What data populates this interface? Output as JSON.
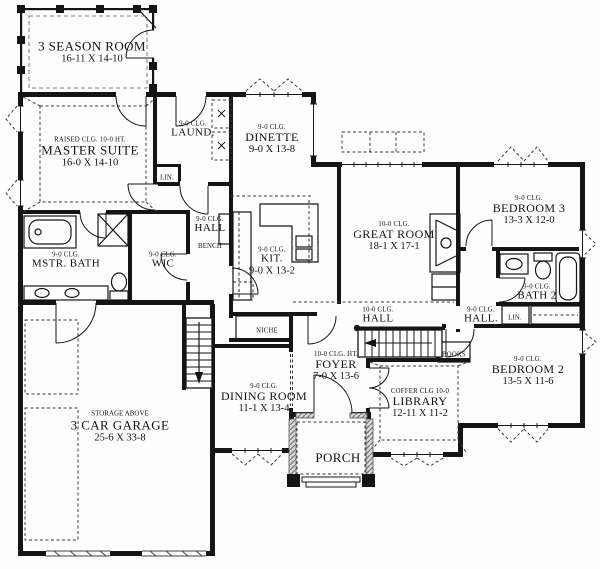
{
  "plan_title": "First floor plan",
  "rooms": {
    "season": {
      "name": "3 SEASON ROOM",
      "dims": "16-11 X 14-10"
    },
    "master": {
      "clg": "RAISED CLG. 10-0 HT.",
      "name": "MASTER SUITE",
      "dims": "16-0 X 14-10"
    },
    "laundry": {
      "clg": "9-0 CLG.",
      "name": "LAUND."
    },
    "dinette": {
      "clg": "9-0 CLG.",
      "name": "DINETTE",
      "dims": "9-0 X 13-8"
    },
    "mstr_bath": {
      "clg": "9-0 CLG.",
      "name": "MSTR. BATH"
    },
    "wic": {
      "clg": "9-0 CLG.",
      "name": "WIC"
    },
    "hall_bench": {
      "clg": "9-0 CLG.",
      "name": "HALL",
      "extra": "BENCH"
    },
    "kitchen": {
      "clg": "9-0 CLG.",
      "name": "KIT.",
      "dims": "9-0 X 13-2"
    },
    "great_room": {
      "clg": "10-0 CLG.",
      "name": "GREAT ROOM",
      "dims": "18-1 X 17-1"
    },
    "bedroom3": {
      "clg": "9-0 CLG.",
      "name": "BEDROOM 3",
      "dims": "13-3 X 12-0"
    },
    "bath2": {
      "clg": "9-0 CLG.",
      "name": "BATH 2"
    },
    "hall_center": {
      "clg": "10-0 CLG.",
      "name": "HALL"
    },
    "hall_bed": {
      "clg": "9-0 CLG.",
      "name": "HALL."
    },
    "bedroom2": {
      "clg": "9-0 CLG.",
      "name": "BEDROOM 2",
      "dims": "13-5 X 11-6"
    },
    "foyer": {
      "clg": "10-0 CLG. HT.",
      "name": "FOYER",
      "dims": "7-0 X 13-6"
    },
    "library": {
      "clg": "COFFER CLG 10-0",
      "name": "LIBRARY",
      "dims": "12-11 X 11-2"
    },
    "dining": {
      "clg": "9-0 CLG.",
      "name": "DINING ROOM",
      "dims": "11-1 X 13-4"
    },
    "porch": {
      "name": "PORCH"
    },
    "garage": {
      "clg": "STORAGE ABOVE",
      "name": "3 CAR GARAGE",
      "dims": "25-6 X 33-8"
    }
  },
  "closets": {
    "lin_laundry": "LIN.",
    "lin_hall": "LIN.",
    "niche": "NICHE",
    "books": "BOOKS",
    "bench": "BENCH"
  },
  "colors": {
    "wall": "#151515",
    "background": "#fefefe",
    "hatch": "#8a8a8a",
    "dash": "#3a3a3a"
  }
}
